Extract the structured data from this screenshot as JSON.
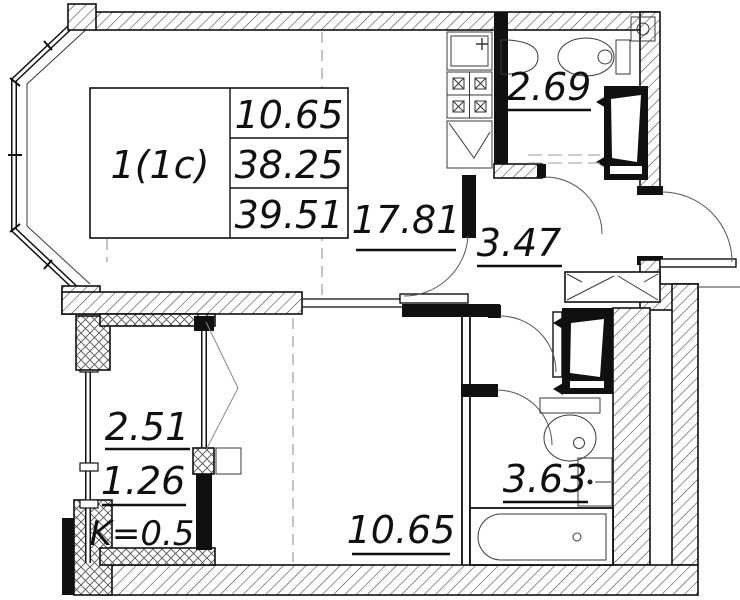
{
  "stamp": {
    "apartment_label": "1(1c)",
    "living_area": "10.65",
    "apartment_area": "38.25",
    "total_area": "39.51"
  },
  "rooms": {
    "living_kitchen_area": "17.81",
    "wc_area": "2.69",
    "hall_area": "3.47",
    "bedroom_area": "10.65",
    "bathroom_area": "3.63",
    "balcony_area": "2.51",
    "balcony_counted_area": "1.26",
    "balcony_coefficient": "K=0.5"
  },
  "colors": {
    "line": "#101010",
    "background": "#ffffff"
  }
}
